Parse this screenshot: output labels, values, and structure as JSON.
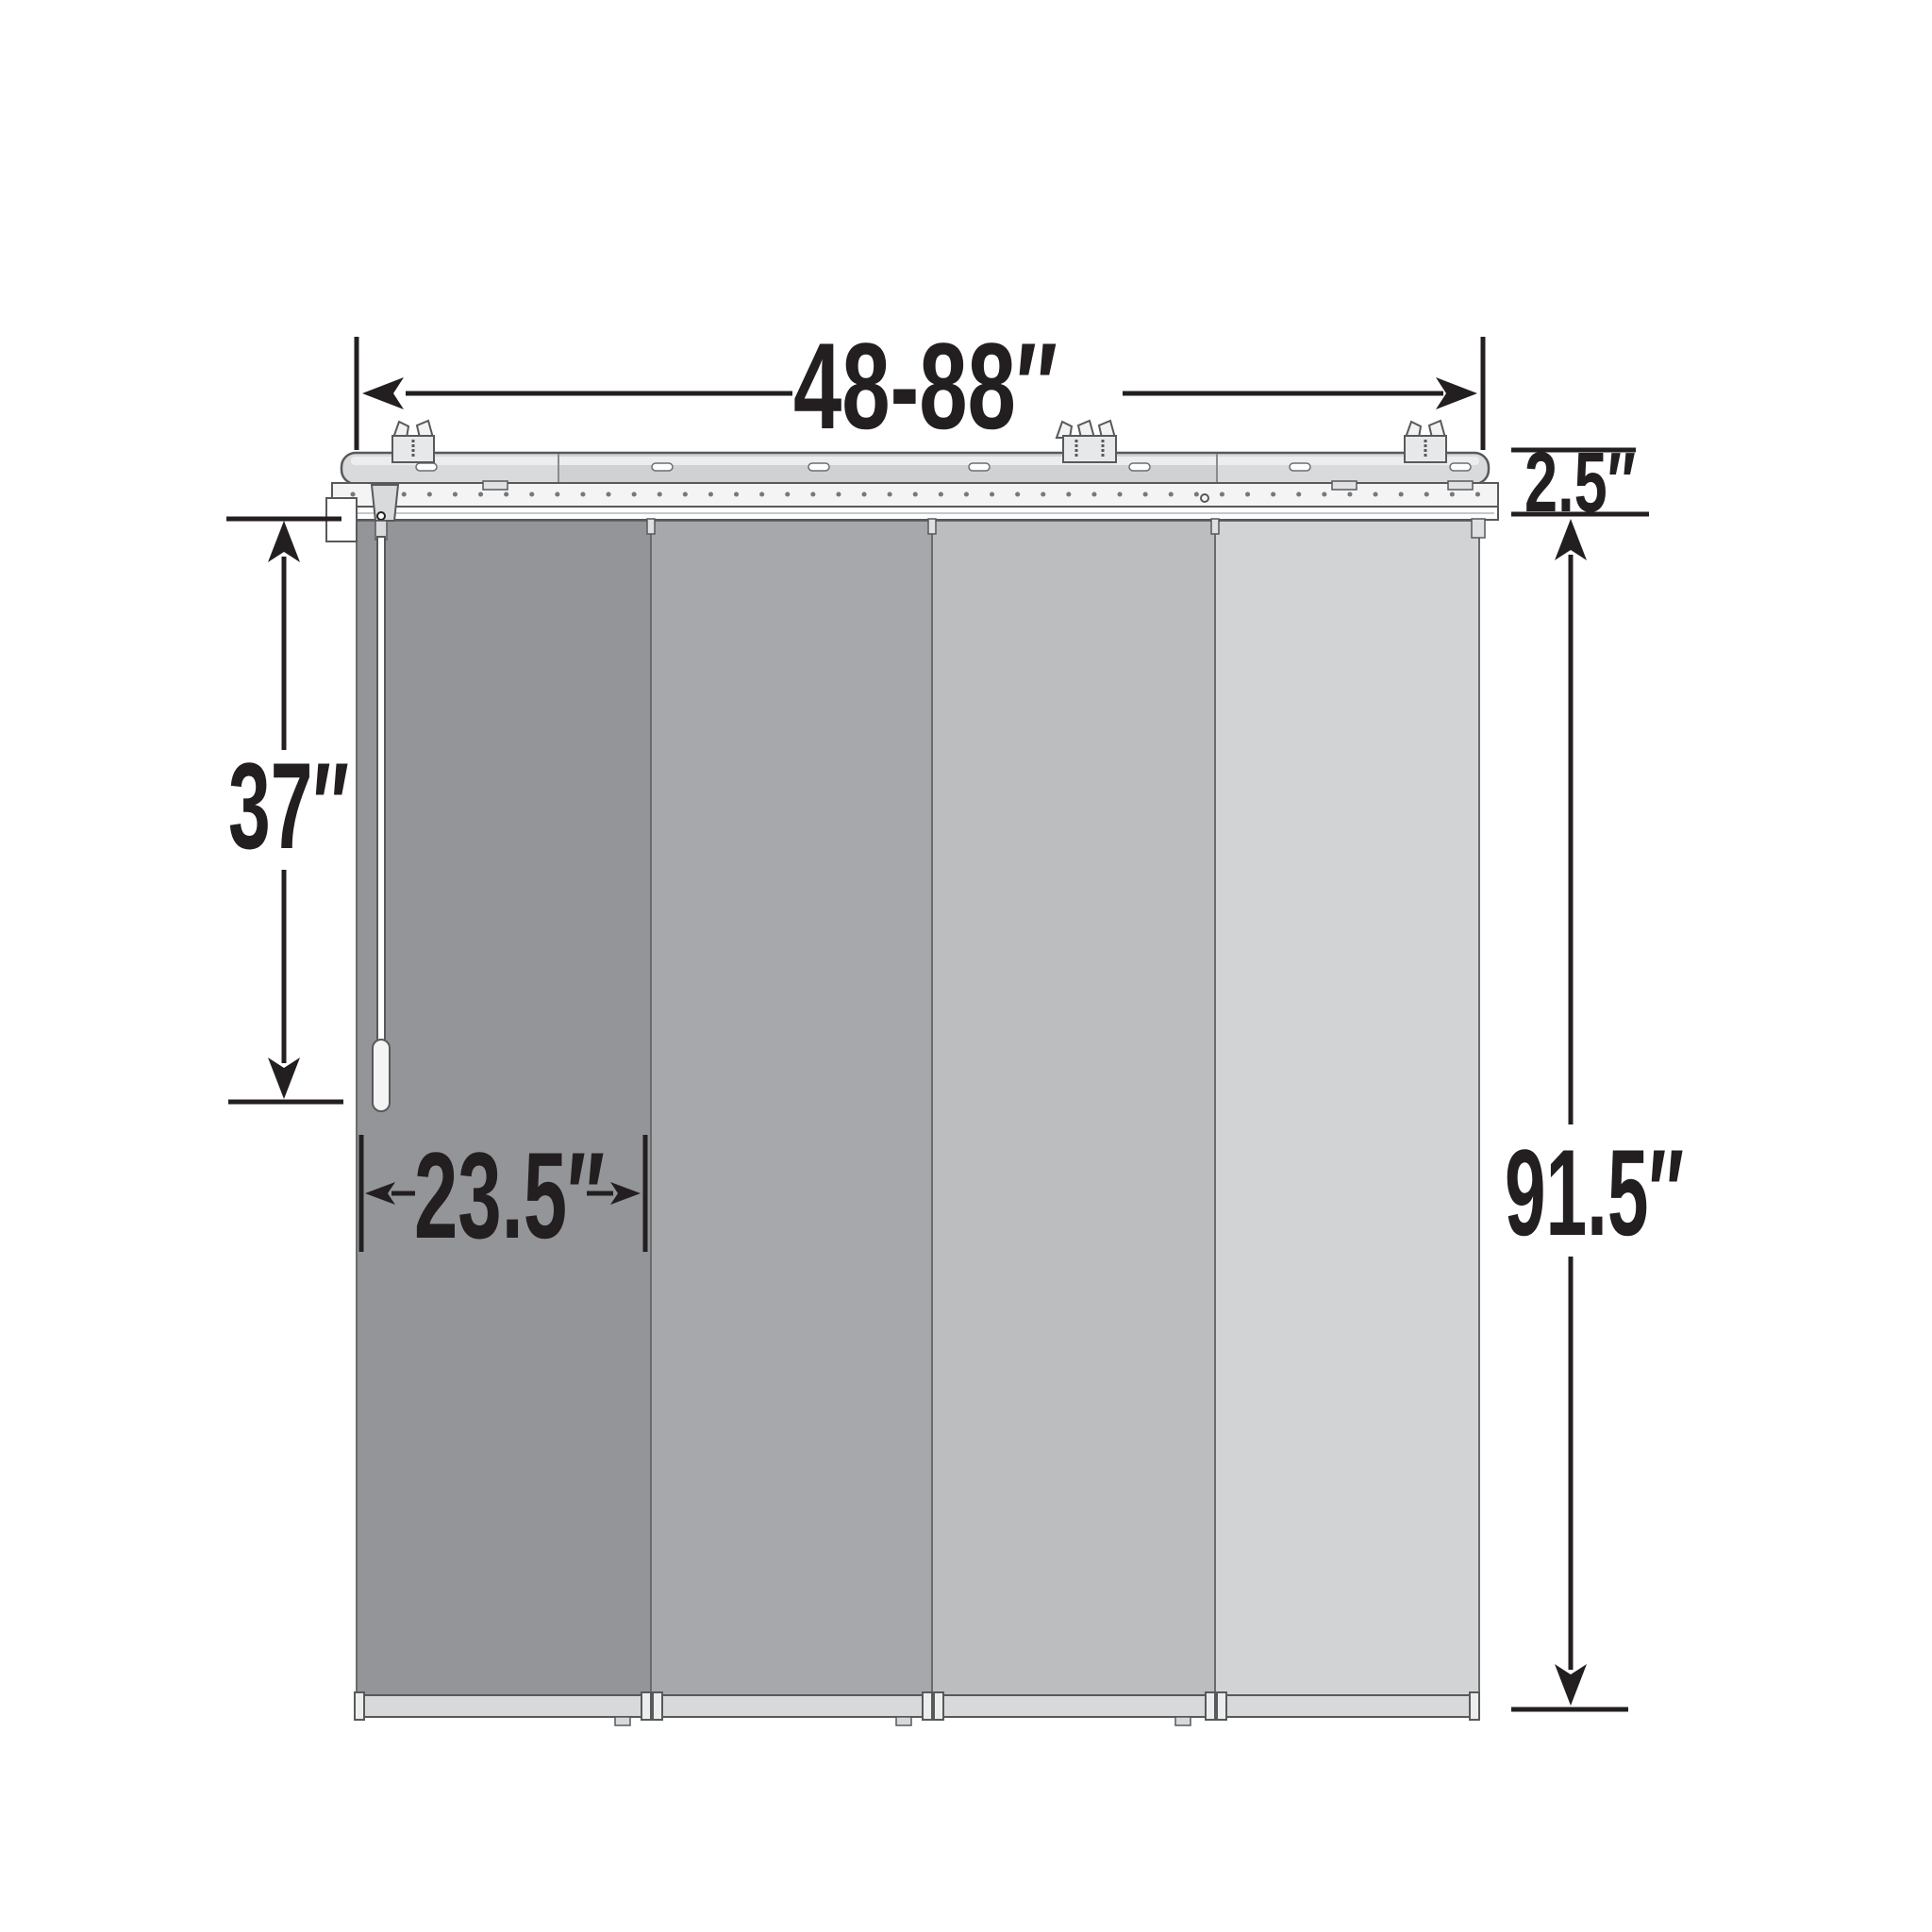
{
  "diagram": {
    "type": "product-dimension-diagram",
    "subject": "4-panel sliding panel track blind",
    "dimensions": {
      "width_range": {
        "label": "48-88″",
        "value": "48-88",
        "unit": "inches"
      },
      "rail_height": {
        "label": "2.5″",
        "value": "2.5",
        "unit": "inches"
      },
      "wand_length": {
        "label": "37″",
        "value": "37",
        "unit": "inches"
      },
      "panel_width": {
        "label": "23.5″",
        "value": "23.5",
        "unit": "inches"
      },
      "product_height": {
        "label": "91.5″",
        "value": "91.5",
        "unit": "inches"
      }
    },
    "panels": [
      {
        "name": "panel-1",
        "color": "#939598"
      },
      {
        "name": "panel-2",
        "color": "#a6a8ab"
      },
      {
        "name": "panel-3",
        "color": "#bbbdbf"
      },
      {
        "name": "panel-4",
        "color": "#d1d3d4"
      }
    ],
    "colors": {
      "line": "#231f20",
      "outline": "#58595b",
      "rail_fill": "#d9dadb",
      "rail_mid_fill": "#d0d1d3",
      "strip_fill": "#f4f4f5",
      "track_fill": "#fdfdfe",
      "bottom_bar_fill": "#d8d9da",
      "end_cap_fill": "#eceded",
      "wand_fill": "#ffffff",
      "background": "#ffffff"
    }
  }
}
